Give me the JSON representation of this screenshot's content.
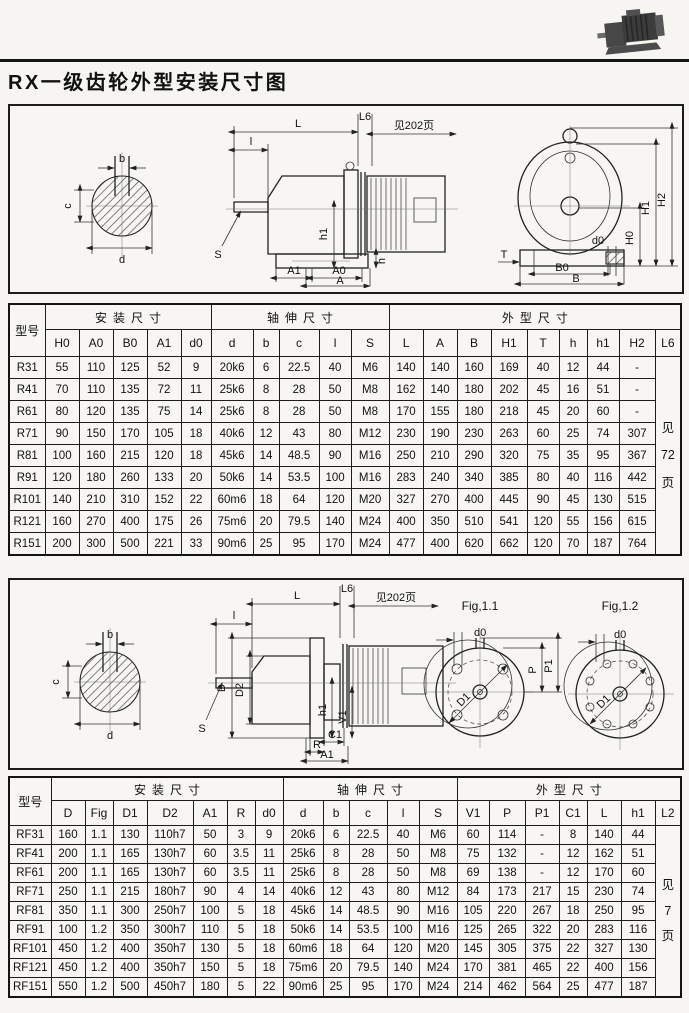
{
  "page_title": "RX一级齿轮外型安装尺寸图",
  "diagram1": {
    "shaft_section": {
      "b": "b",
      "c": "c",
      "d": "d"
    },
    "side_view": {
      "L": "L",
      "l": "l",
      "L6": "L6",
      "see_note": "见202页",
      "h1": "h1",
      "h": "h",
      "S": "S",
      "A1": "A1",
      "A0": "A0",
      "A": "A"
    },
    "front_view": {
      "H0": "H0",
      "H1": "H1",
      "H2": "H2",
      "d0": "d0",
      "T": "T",
      "B0": "B0",
      "B": "B"
    }
  },
  "diagram2": {
    "shaft_section": {
      "b": "b",
      "c": "c",
      "d": "d"
    },
    "side_view": {
      "L": "L",
      "l": "l",
      "L6": "L6",
      "see_note": "见202页",
      "D": "D",
      "D2": "D2",
      "h1": "h1",
      "V1": "V1",
      "C1": "C1",
      "R": "R",
      "A1": "A1",
      "S": "S"
    },
    "fig11": {
      "title": "Fig,1.1",
      "d0": "d0",
      "P": "P",
      "P1": "P1",
      "D1": "D1"
    },
    "fig12": {
      "title": "Fig,1.2",
      "d0": "d0",
      "D1": "D1"
    }
  },
  "table1": {
    "model_header": "型号",
    "groups": [
      {
        "label": "安装尺寸",
        "span": 5
      },
      {
        "label": "轴伸尺寸",
        "span": 5
      },
      {
        "label": "外型尺寸",
        "span": 9
      }
    ],
    "columns": [
      "H0",
      "A0",
      "B0",
      "A1",
      "d0",
      "d",
      "b",
      "c",
      "l",
      "S",
      "L",
      "A",
      "B",
      "H1",
      "T",
      "h",
      "h1",
      "H2",
      "L6"
    ],
    "note_lines": [
      "见",
      "72",
      "页"
    ],
    "rows": [
      [
        "R31",
        "55",
        "110",
        "125",
        "52",
        "9",
        "20k6",
        "6",
        "22.5",
        "40",
        "M6",
        "140",
        "140",
        "160",
        "169",
        "40",
        "12",
        "44",
        "-"
      ],
      [
        "R41",
        "70",
        "110",
        "135",
        "72",
        "11",
        "25k6",
        "8",
        "28",
        "50",
        "M8",
        "162",
        "140",
        "180",
        "202",
        "45",
        "16",
        "51",
        "-"
      ],
      [
        "R61",
        "80",
        "120",
        "135",
        "75",
        "14",
        "25k6",
        "8",
        "28",
        "50",
        "M8",
        "170",
        "155",
        "180",
        "218",
        "45",
        "20",
        "60",
        "-"
      ],
      [
        "R71",
        "90",
        "150",
        "170",
        "105",
        "18",
        "40k6",
        "12",
        "43",
        "80",
        "M12",
        "230",
        "190",
        "230",
        "263",
        "60",
        "25",
        "74",
        "307"
      ],
      [
        "R81",
        "100",
        "160",
        "215",
        "120",
        "18",
        "45k6",
        "14",
        "48.5",
        "90",
        "M16",
        "250",
        "210",
        "290",
        "320",
        "75",
        "35",
        "95",
        "367"
      ],
      [
        "R91",
        "120",
        "180",
        "260",
        "133",
        "20",
        "50k6",
        "14",
        "53.5",
        "100",
        "M16",
        "283",
        "240",
        "340",
        "385",
        "80",
        "40",
        "116",
        "442"
      ],
      [
        "R101",
        "140",
        "210",
        "310",
        "152",
        "22",
        "60m6",
        "18",
        "64",
        "120",
        "M20",
        "327",
        "270",
        "400",
        "445",
        "90",
        "45",
        "130",
        "515"
      ],
      [
        "R121",
        "160",
        "270",
        "400",
        "175",
        "26",
        "75m6",
        "20",
        "79.5",
        "140",
        "M24",
        "400",
        "350",
        "510",
        "541",
        "120",
        "55",
        "156",
        "615"
      ],
      [
        "R151",
        "200",
        "300",
        "500",
        "221",
        "33",
        "90m6",
        "25",
        "95",
        "170",
        "M24",
        "477",
        "400",
        "620",
        "662",
        "120",
        "70",
        "187",
        "764"
      ]
    ]
  },
  "table2": {
    "model_header": "型号",
    "groups": [
      {
        "label": "安装尺寸",
        "span": 7
      },
      {
        "label": "轴伸尺寸",
        "span": 5
      },
      {
        "label": "外型尺寸",
        "span": 7
      }
    ],
    "columns": [
      "D",
      "Fig",
      "D1",
      "D2",
      "A1",
      "R",
      "d0",
      "d",
      "b",
      "c",
      "l",
      "S",
      "V1",
      "P",
      "P1",
      "C1",
      "L",
      "h1",
      "L2"
    ],
    "note_lines": [
      "见",
      "7",
      "页"
    ],
    "rows": [
      [
        "RF31",
        "160",
        "1.1",
        "130",
        "110h7",
        "50",
        "3",
        "9",
        "20k6",
        "6",
        "22.5",
        "40",
        "M6",
        "60",
        "114",
        "-",
        "8",
        "140",
        "44"
      ],
      [
        "RF41",
        "200",
        "1.1",
        "165",
        "130h7",
        "60",
        "3.5",
        "11",
        "25k6",
        "8",
        "28",
        "50",
        "M8",
        "75",
        "132",
        "-",
        "12",
        "162",
        "51"
      ],
      [
        "RF61",
        "200",
        "1.1",
        "165",
        "130h7",
        "60",
        "3.5",
        "11",
        "25k6",
        "8",
        "28",
        "50",
        "M8",
        "69",
        "138",
        "-",
        "12",
        "170",
        "60"
      ],
      [
        "RF71",
        "250",
        "1.1",
        "215",
        "180h7",
        "90",
        "4",
        "14",
        "40k6",
        "12",
        "43",
        "80",
        "M12",
        "84",
        "173",
        "217",
        "15",
        "230",
        "74"
      ],
      [
        "RF81",
        "350",
        "1.1",
        "300",
        "250h7",
        "100",
        "5",
        "18",
        "45k6",
        "14",
        "48.5",
        "90",
        "M16",
        "105",
        "220",
        "267",
        "18",
        "250",
        "95"
      ],
      [
        "RF91",
        "100",
        "1.2",
        "350",
        "300h7",
        "110",
        "5",
        "18",
        "50k6",
        "14",
        "53.5",
        "100",
        "M16",
        "125",
        "265",
        "322",
        "20",
        "283",
        "116"
      ],
      [
        "RF101",
        "450",
        "1.2",
        "400",
        "350h7",
        "130",
        "5",
        "18",
        "60m6",
        "18",
        "64",
        "120",
        "M20",
        "145",
        "305",
        "375",
        "22",
        "327",
        "130"
      ],
      [
        "RF121",
        "450",
        "1.2",
        "400",
        "350h7",
        "150",
        "5",
        "18",
        "75m6",
        "20",
        "79.5",
        "140",
        "M24",
        "170",
        "381",
        "465",
        "22",
        "400",
        "156"
      ],
      [
        "RF151",
        "550",
        "1.2",
        "500",
        "450h7",
        "180",
        "5",
        "22",
        "90m6",
        "25",
        "95",
        "170",
        "M24",
        "214",
        "462",
        "564",
        "25",
        "477",
        "187"
      ]
    ]
  }
}
